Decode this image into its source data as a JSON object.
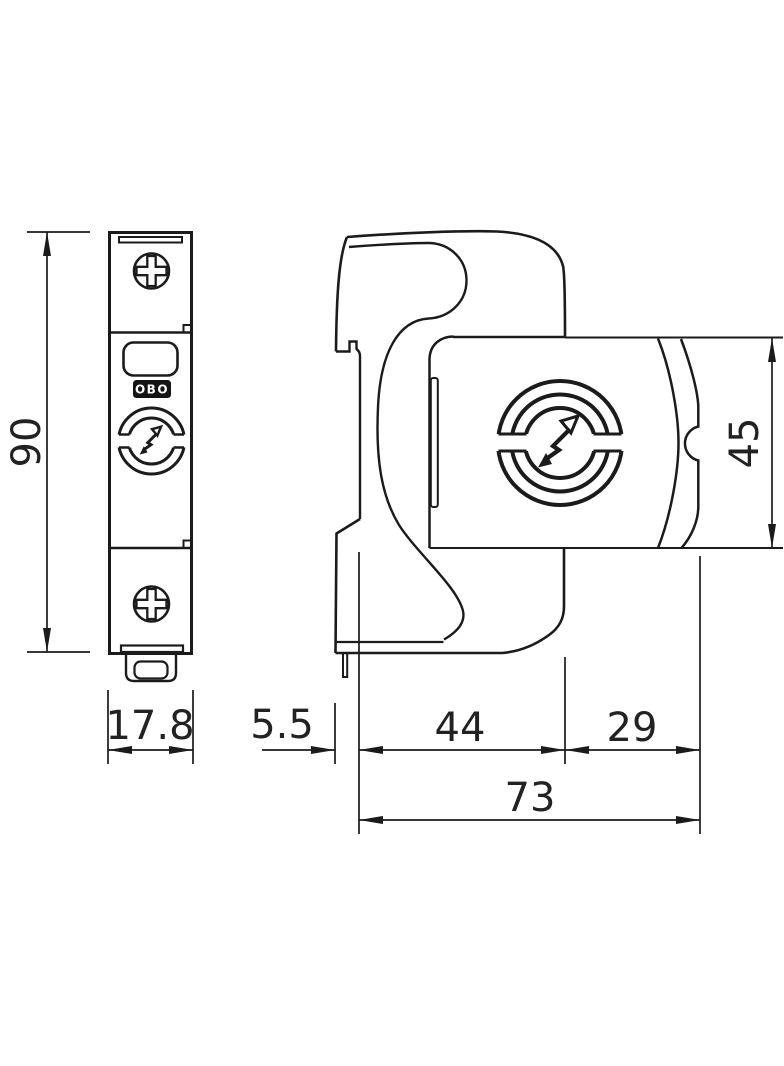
{
  "dimensions": {
    "front_height": "90",
    "front_width": "17.8",
    "clip_offset": "5.5",
    "body_depth": "44",
    "front_depth": "29",
    "total_depth": "73",
    "module_height": "45"
  },
  "branding": {
    "logo_text": "OBO"
  },
  "colors": {
    "line": "#1b1b1b",
    "background": "#ffffff",
    "badge": "#141414"
  }
}
